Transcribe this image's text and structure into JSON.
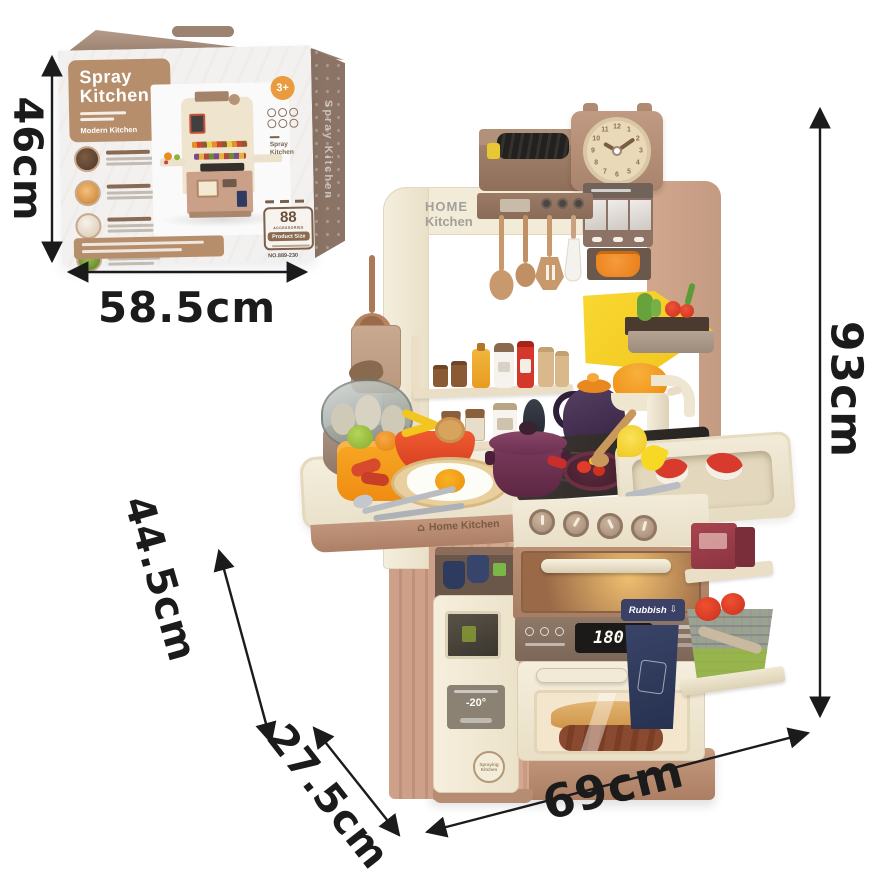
{
  "colors": {
    "box_badge_tan": "#b78e6b",
    "box_side_taupe": "#8b7465",
    "age_badge_orange": "#e99b3d",
    "kitchen_cream": "#f2ebd8",
    "kitchen_pink": "#cba189",
    "kitchen_brown": "#9b7b66",
    "navy_bin": "#2f3a63",
    "accent_yellow": "#f7d22e",
    "accent_orange": "#f0871f",
    "accent_red": "#d8392f",
    "pot_purple": "#6e3050",
    "arrow_black": "#1b1b1b"
  },
  "dimension_labels": {
    "box_height": "46cm",
    "box_width": "58.5cm",
    "toy_height": "93cm",
    "toy_depth": "44.5cm",
    "toy_side_depth": "27.5cm",
    "toy_width": "69cm"
  },
  "box": {
    "title_line1": "Spray",
    "title_line2": "Kitchen",
    "subtitle": "Modern Kitchen",
    "age_badge": "3+",
    "side_label": "Spray Kitchen",
    "mini_label_line1": "Spray",
    "mini_label_line2": "Kitchen",
    "accessories_count": "88",
    "accessories_label": "ACCESSORIES",
    "product_size_label": "Product Size",
    "model_number": "NO.889-230"
  },
  "playset": {
    "brand_line1": "HOME",
    "brand_line2": "Kitchen",
    "counter_brand": "Home Kitchen",
    "rubbish_label": "Rubbish",
    "oven_display_temp": "180",
    "oven_display_unit": "℃",
    "fridge_display_temp": "-20°",
    "fridge_logo_line1": "Spraying",
    "fridge_logo_line2": "Kitchen",
    "clock_numbers": [
      "12",
      "1",
      "2",
      "3",
      "4",
      "5",
      "6",
      "7",
      "8",
      "9",
      "10",
      "11"
    ]
  },
  "icons": {
    "house": "⌂",
    "down_arrow": "⇩"
  }
}
